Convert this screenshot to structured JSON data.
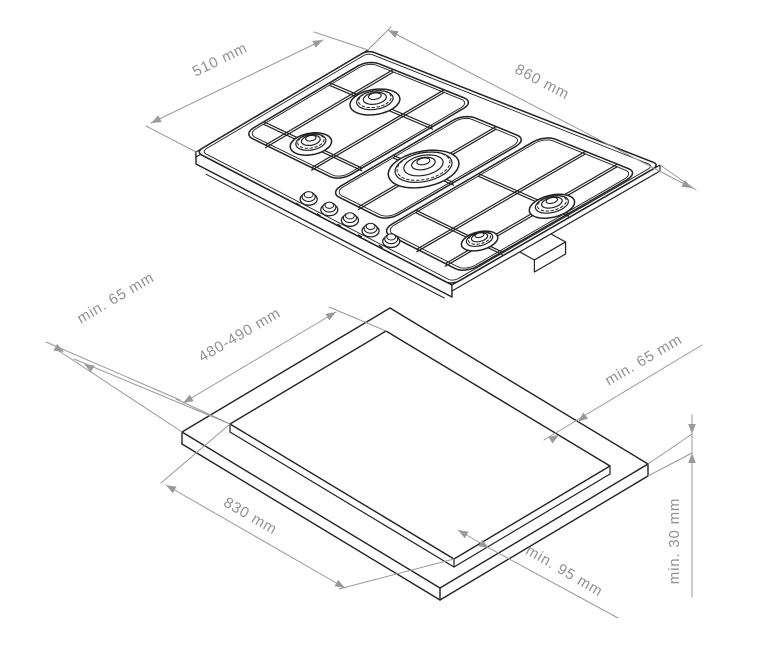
{
  "diagram": {
    "type": "gas-hob-installation-diagram",
    "colors": {
      "line": "#222222",
      "dimension": "#9a9a9a",
      "background": "#ffffff"
    },
    "hob": {
      "burner_count": 5,
      "knob_count": 5,
      "width_label": "860 mm",
      "depth_label": "510 mm"
    },
    "cutout": {
      "cutout_depth_label": "480-490 mm",
      "cutout_width_label": "830 mm",
      "left_clearance_label": "min. 65 mm",
      "back_clearance_label": "min. 65 mm",
      "front_clearance_label": "min. 95 mm",
      "worktop_thickness_label": "min. 30 mm"
    }
  }
}
